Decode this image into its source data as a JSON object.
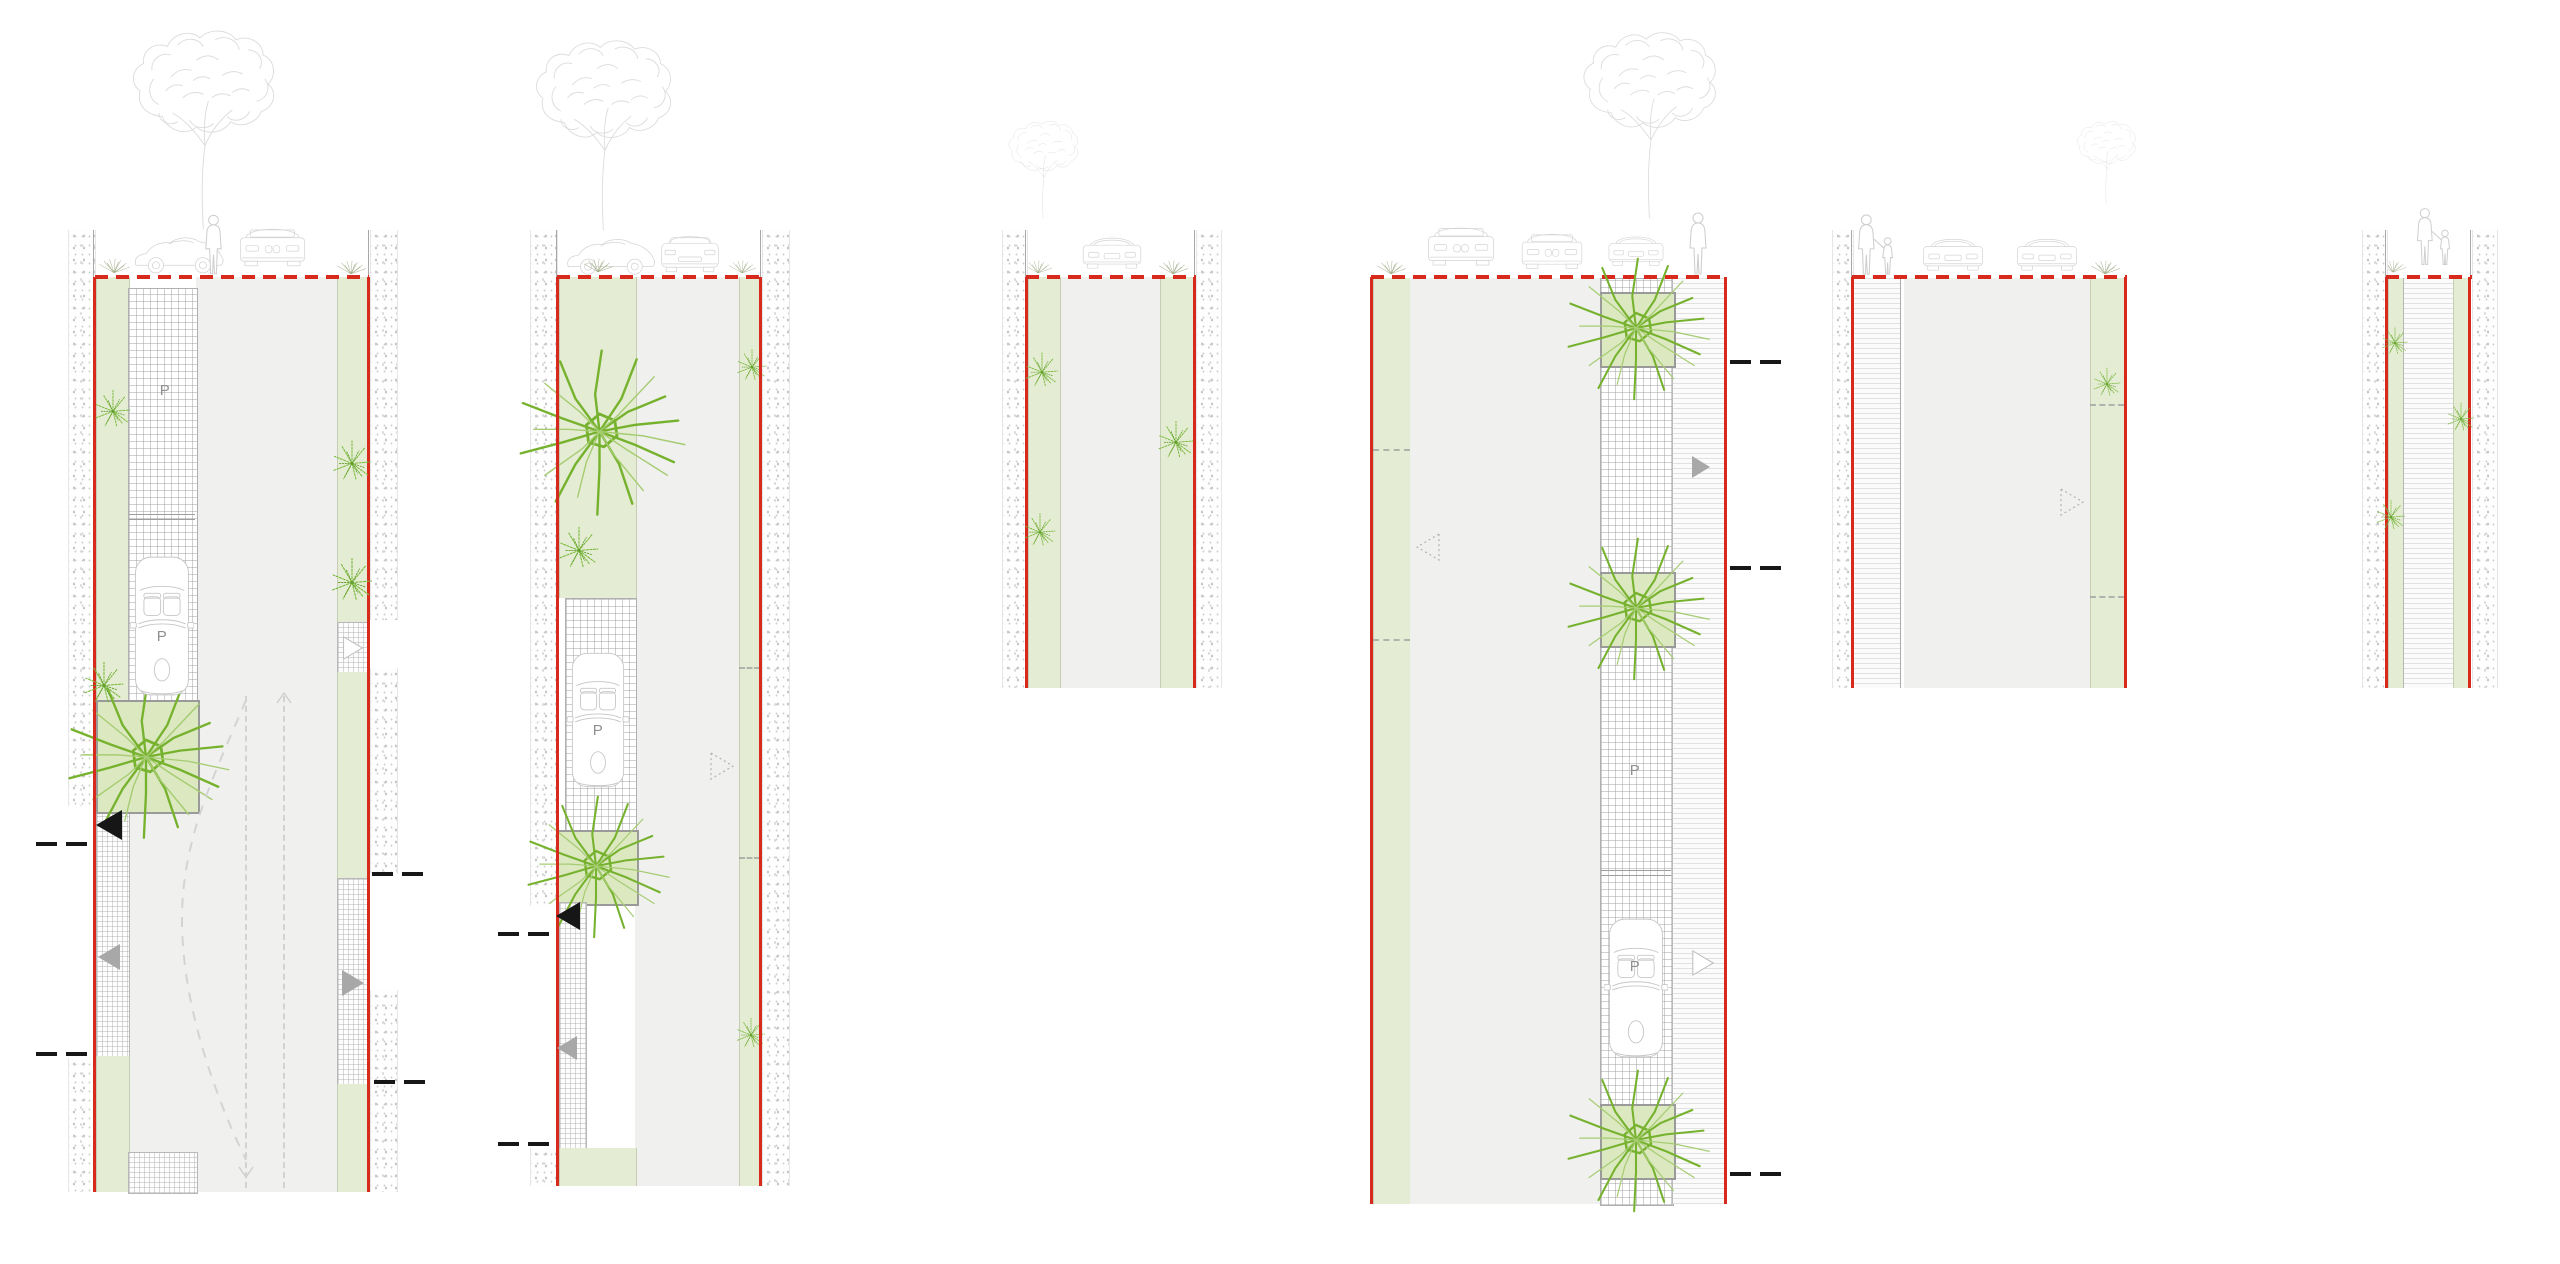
{
  "document": {
    "kind": "urban street redesign plan drawings",
    "background": "#ffffff",
    "panel_count": 6
  },
  "colors": {
    "boundary_red": "#d8291d",
    "verge_green": "#e4edd3",
    "planter_green": "#dbe8c0",
    "street_gray": "#f0f0ef",
    "sketch_gray": "#d6d6d6",
    "plant_green": "#76b22e",
    "plant_green_light": "#a6cc72",
    "arrow_black": "#161616",
    "arrow_gray": "#a8a8a8",
    "marker_black": "#171717"
  },
  "labels": {
    "parking": "P"
  },
  "panels": [
    {
      "id": "street-section-1",
      "height": "tall",
      "parking_bay_label": "P",
      "parked_car_label": "P",
      "elements": [
        "building-wall-hatch",
        "street-tree-elevation",
        "vintage-car-elevation",
        "suv-elevation",
        "pedestrian-figure",
        "green-verges",
        "parallel-parking-bays",
        "parked-convertible-plan",
        "tree-planter",
        "shrubs",
        "two-way-dashed-lane-lines",
        "lane-shift-curve",
        "direction-triangle-black",
        "direction-triangle-gray",
        "section-cut-markers"
      ]
    },
    {
      "id": "street-section-2",
      "height": "tall",
      "parked_car_label": "P",
      "elements": [
        "building-wall-hatch",
        "street-tree-elevation",
        "vintage-car-elevation",
        "sedan-rear-elevation",
        "wide-green-verge",
        "tree-plan-symbol",
        "parking-bay",
        "parked-convertible-plan",
        "tree-planter",
        "shrubs",
        "direction-triangle-black",
        "direction-triangle-gray",
        "direction-triangle-dotted",
        "section-cut-markers"
      ]
    },
    {
      "id": "street-section-3",
      "height": "short",
      "elements": [
        "building-wall-hatch",
        "street-tree-elevation",
        "car-elevation",
        "green-verges",
        "shrubs"
      ]
    },
    {
      "id": "street-section-4",
      "height": "tall",
      "parking_bay_label": "P",
      "parked_car_label": "P",
      "elements": [
        "street-tree-elevation",
        "suv-elevation",
        "van-elevation",
        "vintage-car-elevation",
        "pedestrian-figure",
        "green-verge",
        "tree-planters",
        "parking-bay",
        "parked-convertible-plan",
        "sidewalk-hatch",
        "direction-triangle-gray",
        "direction-triangle-dotted",
        "section-cut-markers"
      ]
    },
    {
      "id": "street-section-5",
      "height": "short",
      "elements": [
        "building-wall-hatch",
        "pedestrian-with-child",
        "car-elevations",
        "sidewalk-hatch",
        "green-verge",
        "shrub",
        "direction-triangle-dotted",
        "street-tree-elevation"
      ]
    },
    {
      "id": "street-section-6",
      "height": "short",
      "elements": [
        "building-wall-hatch",
        "pedestrian-with-child",
        "green-verges",
        "pedestrian-path-hatch",
        "shrubs"
      ]
    }
  ]
}
